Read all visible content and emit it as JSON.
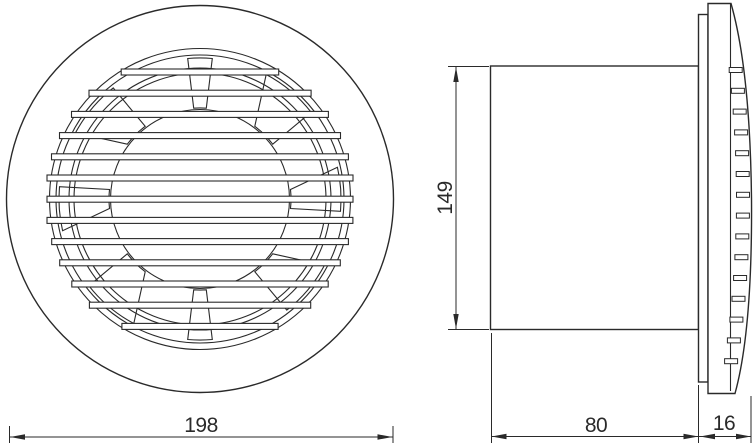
{
  "dims": {
    "front_diameter": "198",
    "side_height": "149",
    "side_depth": "80",
    "side_cover_depth": "16"
  },
  "colors": {
    "line": "#2a2a2a",
    "background": "#ffffff"
  }
}
